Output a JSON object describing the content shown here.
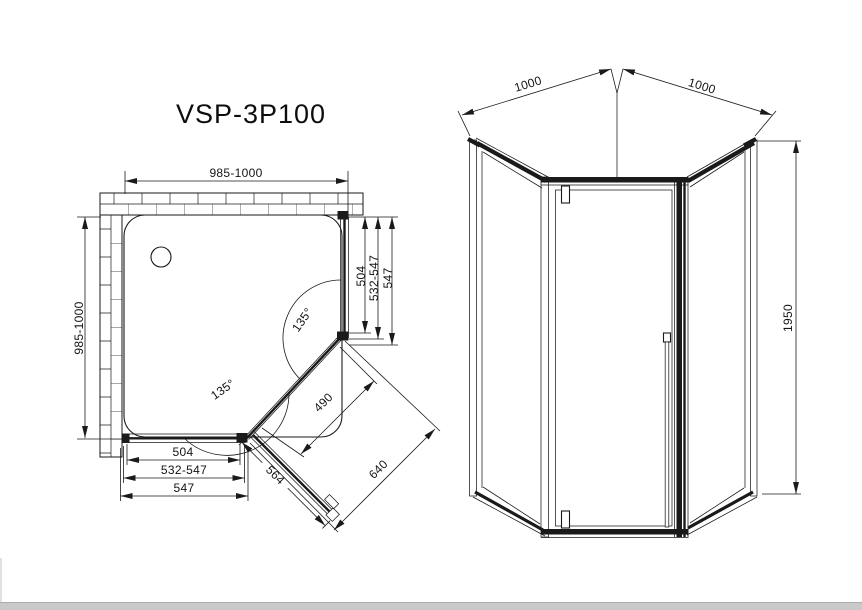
{
  "app": {
    "background_color": "#ffffff",
    "line_color": "#1a1a1a",
    "footer_bar_color": "#c9c9c9"
  },
  "title": "VSP-3P100",
  "plan_view": {
    "dim_width_top": "985-1000",
    "dim_depth_left": "985-1000",
    "side_dims": {
      "glass": "504",
      "adjust_range": "532-547",
      "full": "547"
    },
    "bottom_dims": {
      "glass": "504",
      "adjust_range": "532-547",
      "full": "547"
    },
    "angle_top": "135°",
    "angle_bottom": "135°",
    "door_open_width": "564",
    "door_opening": "490",
    "front_width": "640"
  },
  "front_view": {
    "dim_side_left": "1000",
    "dim_side_right": "1000",
    "dim_height": "1950"
  }
}
